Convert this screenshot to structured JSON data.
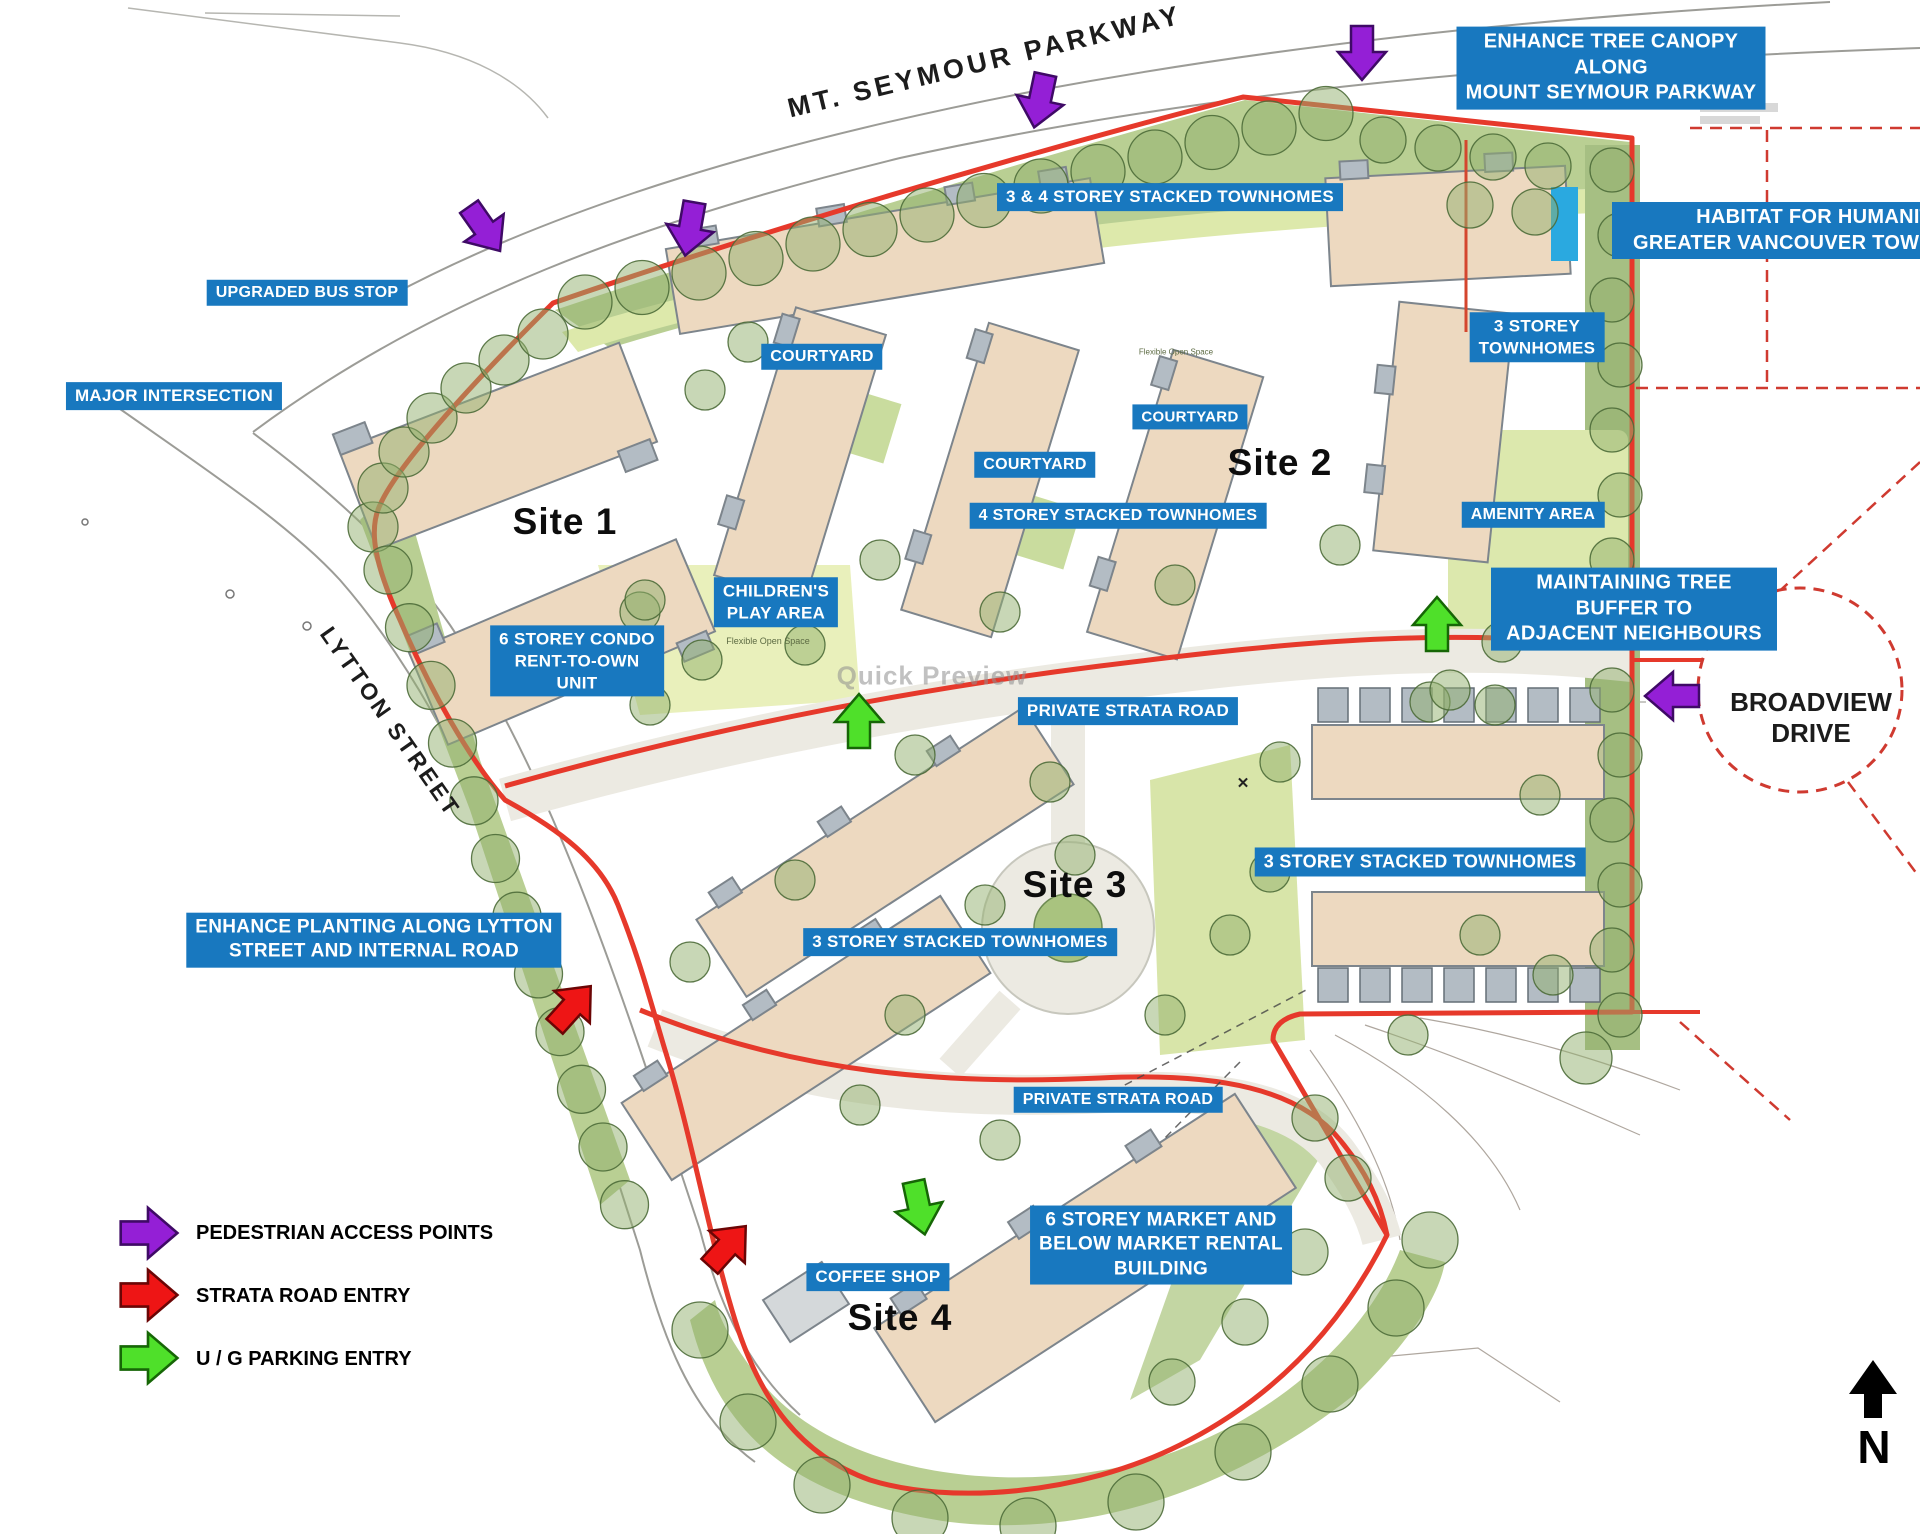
{
  "streets": {
    "parkway": "MT.  SEYMOUR PARKWAY",
    "lytton": "LYTTON STREET",
    "broadview": "BROADVIEW\nDRIVE"
  },
  "sites": {
    "site1": "Site 1",
    "site2": "Site 2",
    "site3": "Site 3",
    "site4": "Site 4"
  },
  "annotations": {
    "canopy": "ENHANCE TREE CANOPY ALONG\nMOUNT SEYMOUR PARKWAY",
    "habitat": "HABITAT FOR HUMANITY\nGREATER VANCOUVER TOWNHOMES",
    "bus_stop": "UPGRADED BUS STOP",
    "major_intersection": "MAJOR INTERSECTION",
    "stacked_3_4": "3 & 4 STOREY STACKED TOWNHOMES",
    "townhomes_3": "3 STOREY\nTOWNHOMES",
    "courtyard": "COURTYARD",
    "stacked_4": "4 STOREY STACKED TOWNHOMES",
    "amenity": "AMENITY AREA",
    "children": "CHILDREN'S\nPLAY AREA",
    "condo": "6 STOREY CONDO\nRENT-TO-OWN\nUNIT",
    "buffer": "MAINTAINING TREE BUFFER TO\nADJACENT NEIGHBOURS",
    "strata_road": "PRIVATE STRATA ROAD",
    "stacked_3": "3 STOREY STACKED TOWNHOMES",
    "planting": "ENHANCE PLANTING ALONG LYTTON\nSTREET AND INTERNAL ROAD",
    "market": "6 STOREY MARKET AND\nBELOW MARKET RENTAL\nBUILDING",
    "coffee": "COFFEE SHOP"
  },
  "legend": {
    "items": [
      {
        "id": "pedestrian",
        "color": "#941fd6",
        "label": "PEDESTRIAN ACCESS POINTS"
      },
      {
        "id": "strata",
        "color": "#ee1515",
        "label": "STRATA ROAD ENTRY"
      },
      {
        "id": "parking",
        "color": "#4fe02a",
        "label": "U / G PARKING ENTRY"
      }
    ]
  },
  "compass": {
    "north": "N"
  },
  "watermark": "Quick Preview",
  "small_texts": {
    "flexible_open_space": "Flexible Open Space"
  },
  "colors": {
    "label_bg": "#1878bf",
    "boundary_red": "#e6392b",
    "arrow_purple": "#941fd6",
    "arrow_red": "#ee1515",
    "arrow_green": "#4fe02a",
    "cyan_accent": "#2aa9e0",
    "building_fill": "#edd9c0",
    "tree_green": "#92b06e"
  }
}
